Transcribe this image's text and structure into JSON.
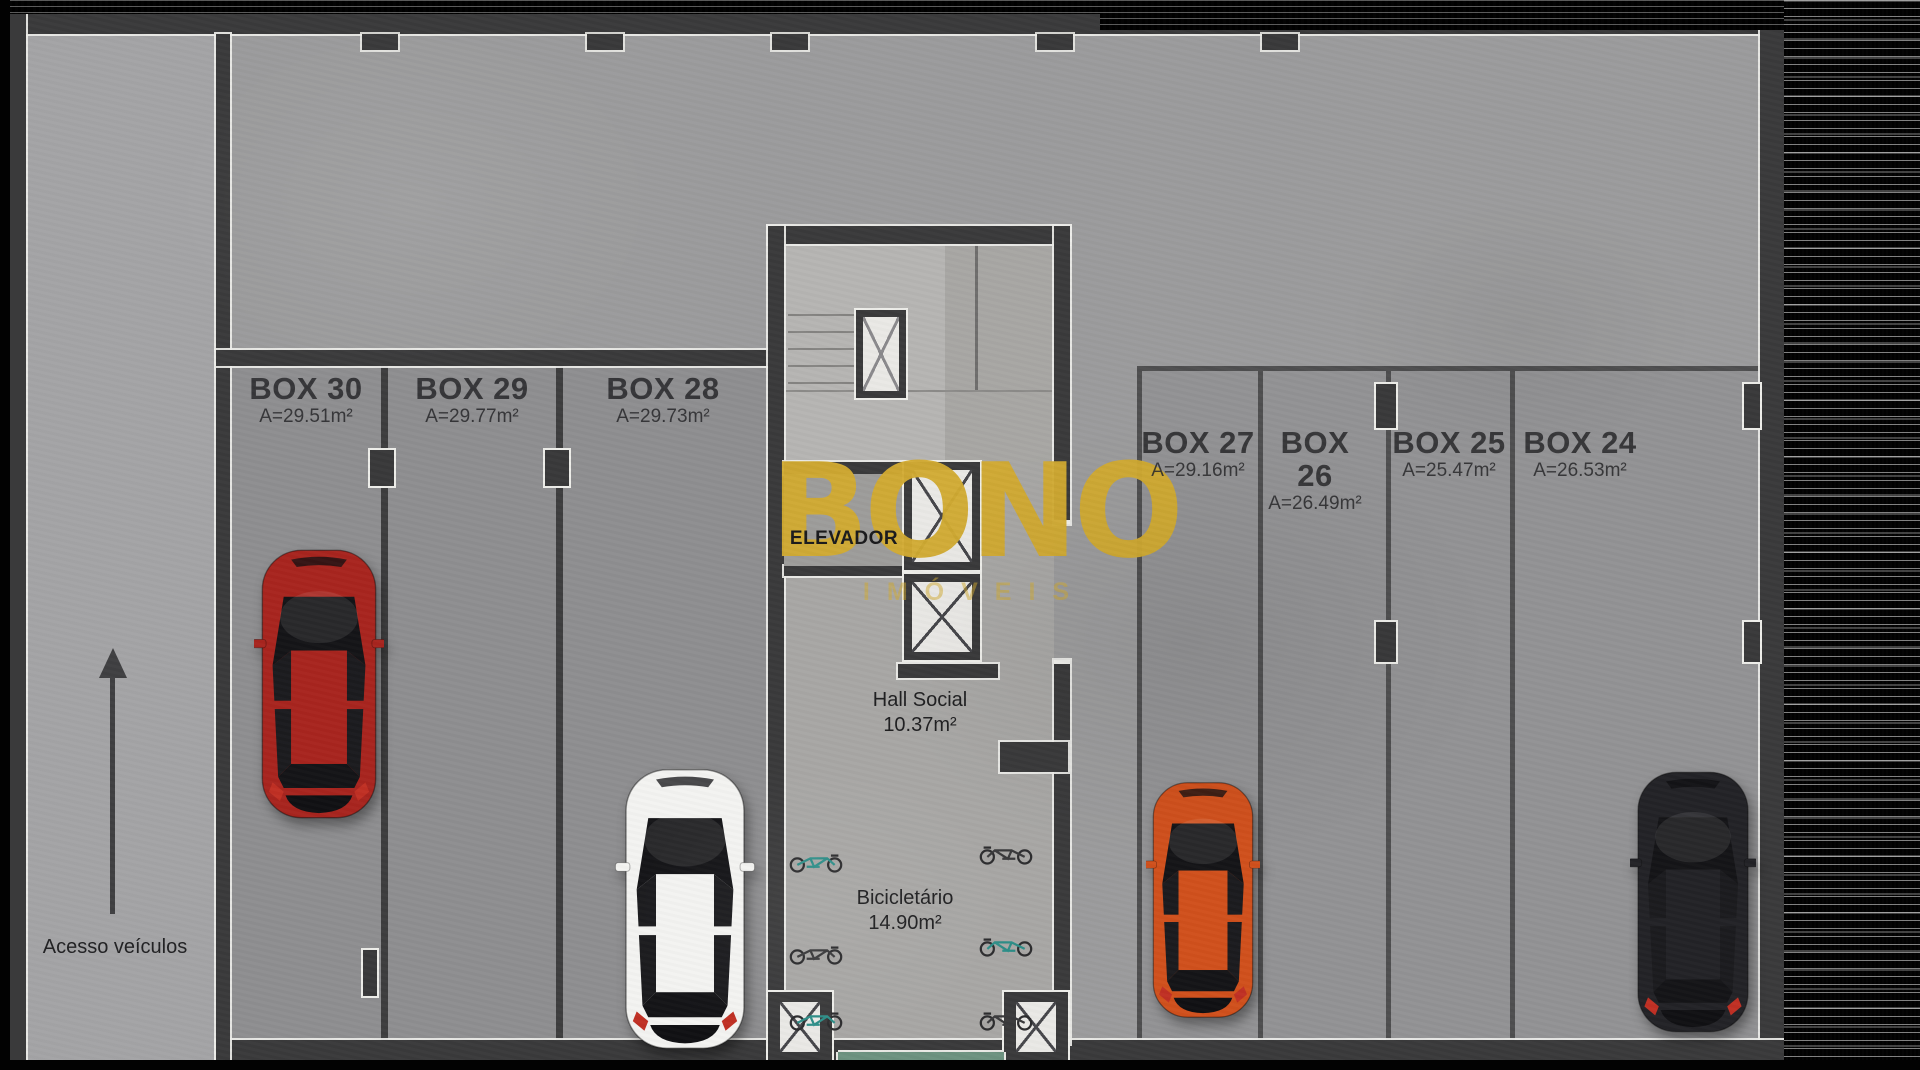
{
  "watermark": {
    "brand": "BONO",
    "subtitle": "IMÓVEIS",
    "gold": "#d2ab31"
  },
  "access": {
    "label": "Acesso veículos"
  },
  "core": {
    "elevator_label": "ELEVADOR",
    "hall_name": "Hall Social",
    "hall_area": "10.37m²",
    "bike_name": "Bicicletário",
    "bike_area": "14.90m²"
  },
  "boxes": [
    {
      "name": "BOX 30",
      "area": "A=29.51m²"
    },
    {
      "name": "BOX 29",
      "area": "A=29.77m²"
    },
    {
      "name": "BOX 28",
      "area": "A=29.73m²"
    },
    {
      "name": "BOX 27",
      "area": "A=29.16m²"
    },
    {
      "name": "BOX 26",
      "area": "A=26.49m²"
    },
    {
      "name": "BOX 25",
      "area": "A=25.47m²"
    },
    {
      "name": "BOX 24",
      "area": "A=26.53m²"
    }
  ],
  "cars": [
    {
      "id": "red-car",
      "color": "#a8251e"
    },
    {
      "id": "white-car",
      "color": "#f3f3f1"
    },
    {
      "id": "orange-car",
      "color": "#d0501c"
    },
    {
      "id": "black-car",
      "color": "#232327"
    }
  ],
  "accents": {
    "mat_green": "#6d9280"
  }
}
